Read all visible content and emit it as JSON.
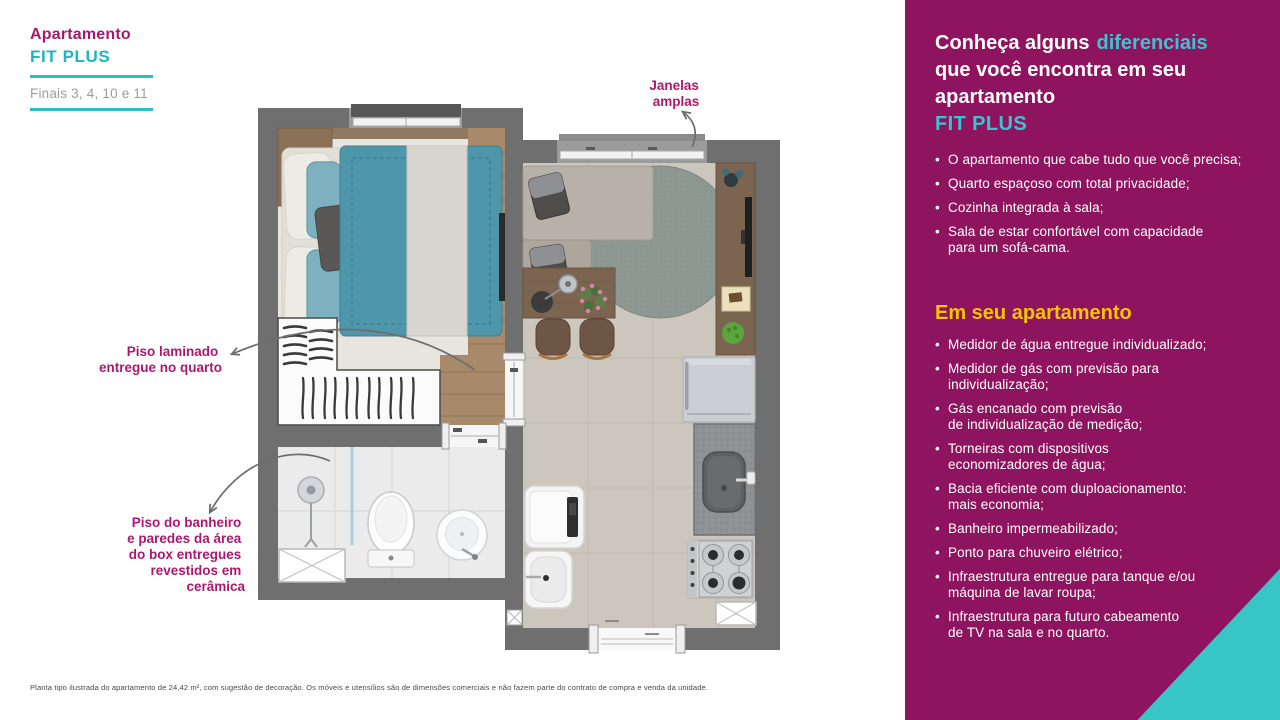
{
  "header": {
    "title": "Apartamento",
    "subtitle": "FIT PLUS",
    "finals": "Finais 3, 4, 10 e 11"
  },
  "plan_annotations": {
    "windows_line1": "Janelas",
    "windows_line2": "amplas",
    "laminate_line1": "Piso laminado",
    "laminate_line2": "entregue no quarto",
    "bath_line1": "Piso do banheiro",
    "bath_line2": "e paredes da área",
    "bath_line3": "do box entregues",
    "bath_line4": "revestidos em",
    "bath_line5": "cerâmica"
  },
  "panel": {
    "title_part1": "Conheça alguns",
    "title_accent": "diferenciais",
    "title_line2": "que você encontra em seu",
    "title_line3": "apartamento",
    "title_line4": "FIT PLUS",
    "features": [
      "O apartamento que cabe tudo que você precisa;",
      "Quarto espaçoso com total privacidade;",
      "Cozinha integrada à sala;",
      "Sala de estar confortável com capacidade\npara um sofá-cama."
    ],
    "section_title": "Em seu apartamento",
    "items": [
      "Medidor de água entregue individualizado;",
      "Medidor de gás com previsão para\nindividualização;",
      "Gás encanado com previsão\nde individualização de medição;",
      "Torneiras com dispositivos\neconomizadores de água;",
      "Bacia eficiente com duploacionamento:\nmais economia;",
      "Banheiro impermeabilizado;",
      "Ponto para chuveiro elétrico;",
      "Infraestrutura entregue para tanque e/ou\nmáquina de lavar roupa;",
      "Infraestrutura para futuro cabeamento\nde TV na sala e no quarto."
    ]
  },
  "footnote": "Planta tipo ilustrada do apartamento de 24,42 m², com sugestão de decoração. Os móveis e utensílios são de dimensões comerciais e não fazem parte do contrato de compra e venda da unidade.",
  "colors": {
    "panel_magenta": "#8e145f",
    "accent_teal": "#38c5c6",
    "accent_yellow": "#f6c400",
    "annotation_magenta": "#ad176e",
    "wall_gray": "#6f6f6f"
  }
}
